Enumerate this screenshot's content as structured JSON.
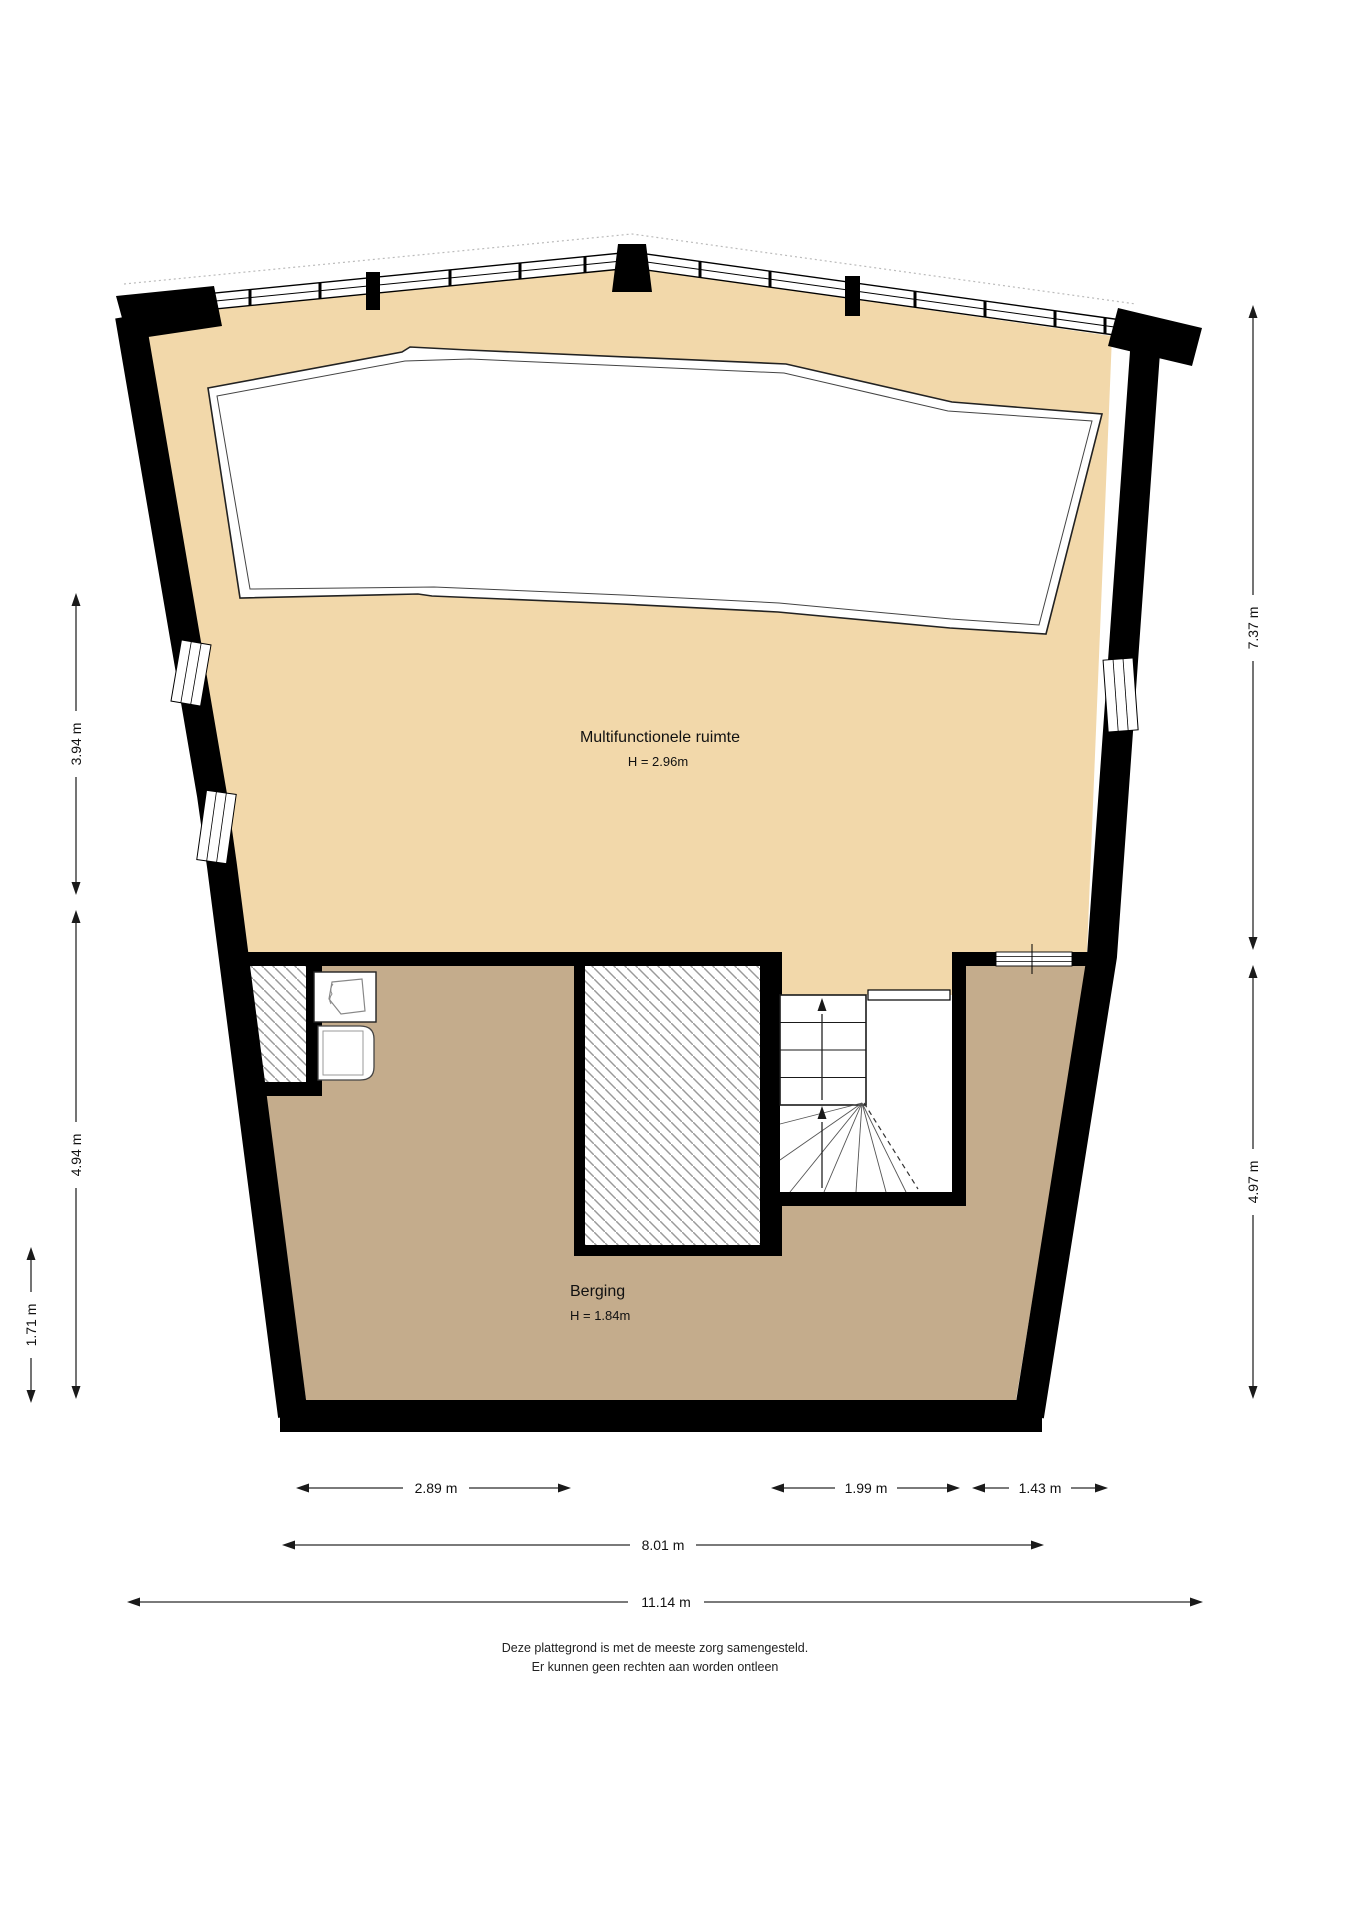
{
  "plan": {
    "rooms": [
      {
        "name": "Multifunctionele ruimte",
        "height_label": "H = 2.96m"
      },
      {
        "name": "Berging",
        "height_label": "H = 1.84m"
      }
    ],
    "dimensions": {
      "left": [
        "3.94 m",
        "4.94 m",
        "1.71 m"
      ],
      "right": [
        "7.37 m",
        "4.97 m"
      ],
      "bottom": [
        "2.89 m",
        "1.99 m",
        "1.43 m",
        "8.01 m",
        "11.14 m"
      ]
    },
    "footer": [
      "Deze plattegrond is met de meeste zorg samengesteld.",
      "Er kunnen geen rechten aan worden ontleen"
    ],
    "colors": {
      "room_upper": "#f2d8aa",
      "room_lower": "#c4ac8c",
      "wall": "#000000",
      "hatch_line": "#9a9a9a"
    }
  }
}
